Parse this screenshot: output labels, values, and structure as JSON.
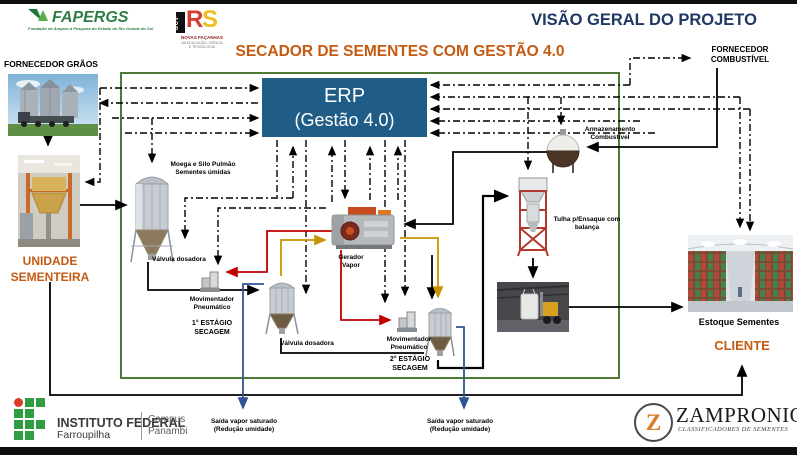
{
  "header": {
    "fapergs": {
      "name": "FAPERGS",
      "tagline": "Fundação de Amparo à Pesquisa do Estado do Rio Grande do Sul"
    },
    "rs": {
      "gov": "GOV",
      "sigla_r": "R",
      "sigla_s": "S",
      "line1": "NOVAS FAÇANHAS",
      "line2": "NA EDUCAÇÃO, CIÊNCIA E TECNOLOGIA"
    },
    "title": "VISÃO GERAL DO PROJETO"
  },
  "diagram": {
    "title": "SECADOR DE SEMENTES COM GESTÃO 4.0",
    "erp": {
      "line1": "ERP",
      "line2": "(Gestão 4.0)"
    },
    "fornecedor_graos": "FORNECEDOR GRÃOS",
    "fornecedor_combustivel_l1": "FORNECEDOR",
    "fornecedor_combustivel_l2": "COMBUSTÍVEL",
    "unidade_l1": "UNIDADE",
    "unidade_l2": "SEMENTEIRA",
    "moega_l1": "Moega e Silo Pulmão",
    "moega_l2": "Sementes úmidas",
    "valvula": "Válvula dosadora",
    "mov_l1": "Movimentador",
    "mov_l2": "Pneumático",
    "estagio1_l1": "1° ESTÁGIO",
    "estagio1_l2": "SECAGEM",
    "estagio2_l1": "2° ESTÁGIO",
    "estagio2_l2": "SECAGEM",
    "gerador_l1": "Gerador",
    "gerador_l2": "Vapor",
    "armazenamento_l1": "Armazenamento",
    "armazenamento_l2": "Combustível",
    "tulha_l1": "Tulha p/Ensaque com",
    "tulha_l2": "balança",
    "estoque": "Estoque Sementes",
    "cliente": "CLIENTE",
    "saida_l1": "Saída vapor saturado",
    "saida_l2": "(Redução umidade)"
  },
  "footer": {
    "if_name": "INSTITUTO FEDERAL",
    "if_unit": "Farroupilha",
    "campus_l1": "Campus",
    "campus_l2": "Panambi",
    "zampronio_z": "Z",
    "zampronio_name": "ZAMPRONIO",
    "zampronio_sub": "CLASSIFICADORES  DE  SEMENTES"
  },
  "colors": {
    "title_navy": "#1F3864",
    "accent_orange": "#C55A11",
    "erp_blue": "#1F5C86",
    "frame_green": "#4D7A35",
    "line_red": "#C00000",
    "line_yellow": "#C79500",
    "line_blue": "#2F5496",
    "line_black": "#000000"
  }
}
